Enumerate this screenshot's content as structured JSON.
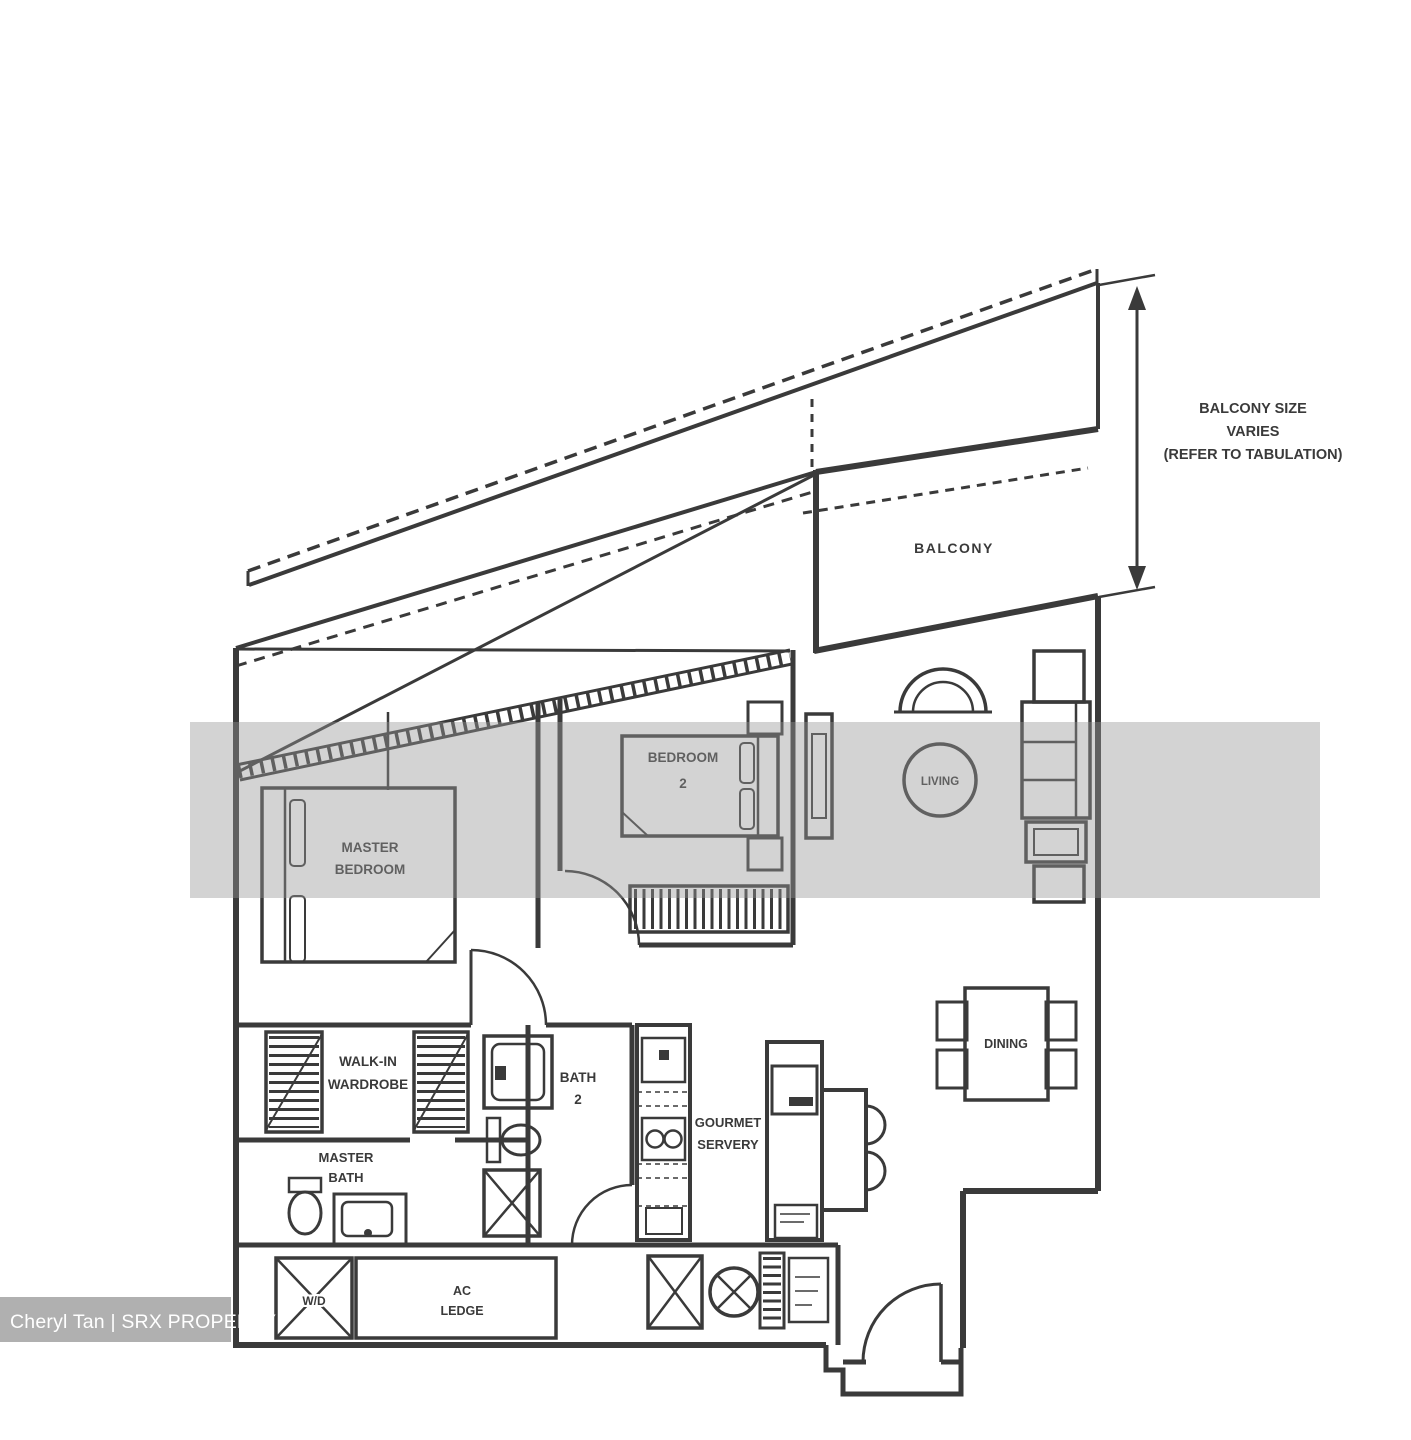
{
  "colors": {
    "background": "#ffffff",
    "line": "#3a3a3a",
    "mid_band": "#969696",
    "bottom_band": "#ababab",
    "watermark_text": "#ffffff"
  },
  "annotation": {
    "line1": "BALCONY SIZE",
    "line2": "VARIES",
    "line3": "(REFER TO TABULATION)"
  },
  "rooms": {
    "balcony": {
      "label": "BALCONY"
    },
    "living": {
      "label": "LIVING"
    },
    "dining": {
      "label": "DINING"
    },
    "bedroom2": {
      "line1": "BEDROOM",
      "line2": "2"
    },
    "master_bedroom": {
      "line1": "MASTER",
      "line2": "BEDROOM"
    },
    "walk_in_wardrobe": {
      "line1": "WALK-IN",
      "line2": "WARDROBE"
    },
    "bath2": {
      "line1": "BATH",
      "line2": "2"
    },
    "master_bath": {
      "line1": "MASTER",
      "line2": "BATH"
    },
    "gourmet_servery": {
      "line1": "GOURMET",
      "line2": "SERVERY"
    },
    "ac_ledge": {
      "line1": "AC",
      "line2": "LEDGE"
    },
    "washer_dryer": {
      "label": "W/D"
    }
  },
  "watermark": {
    "agent": "Cheryl Tan | SRX PROPERTY"
  }
}
